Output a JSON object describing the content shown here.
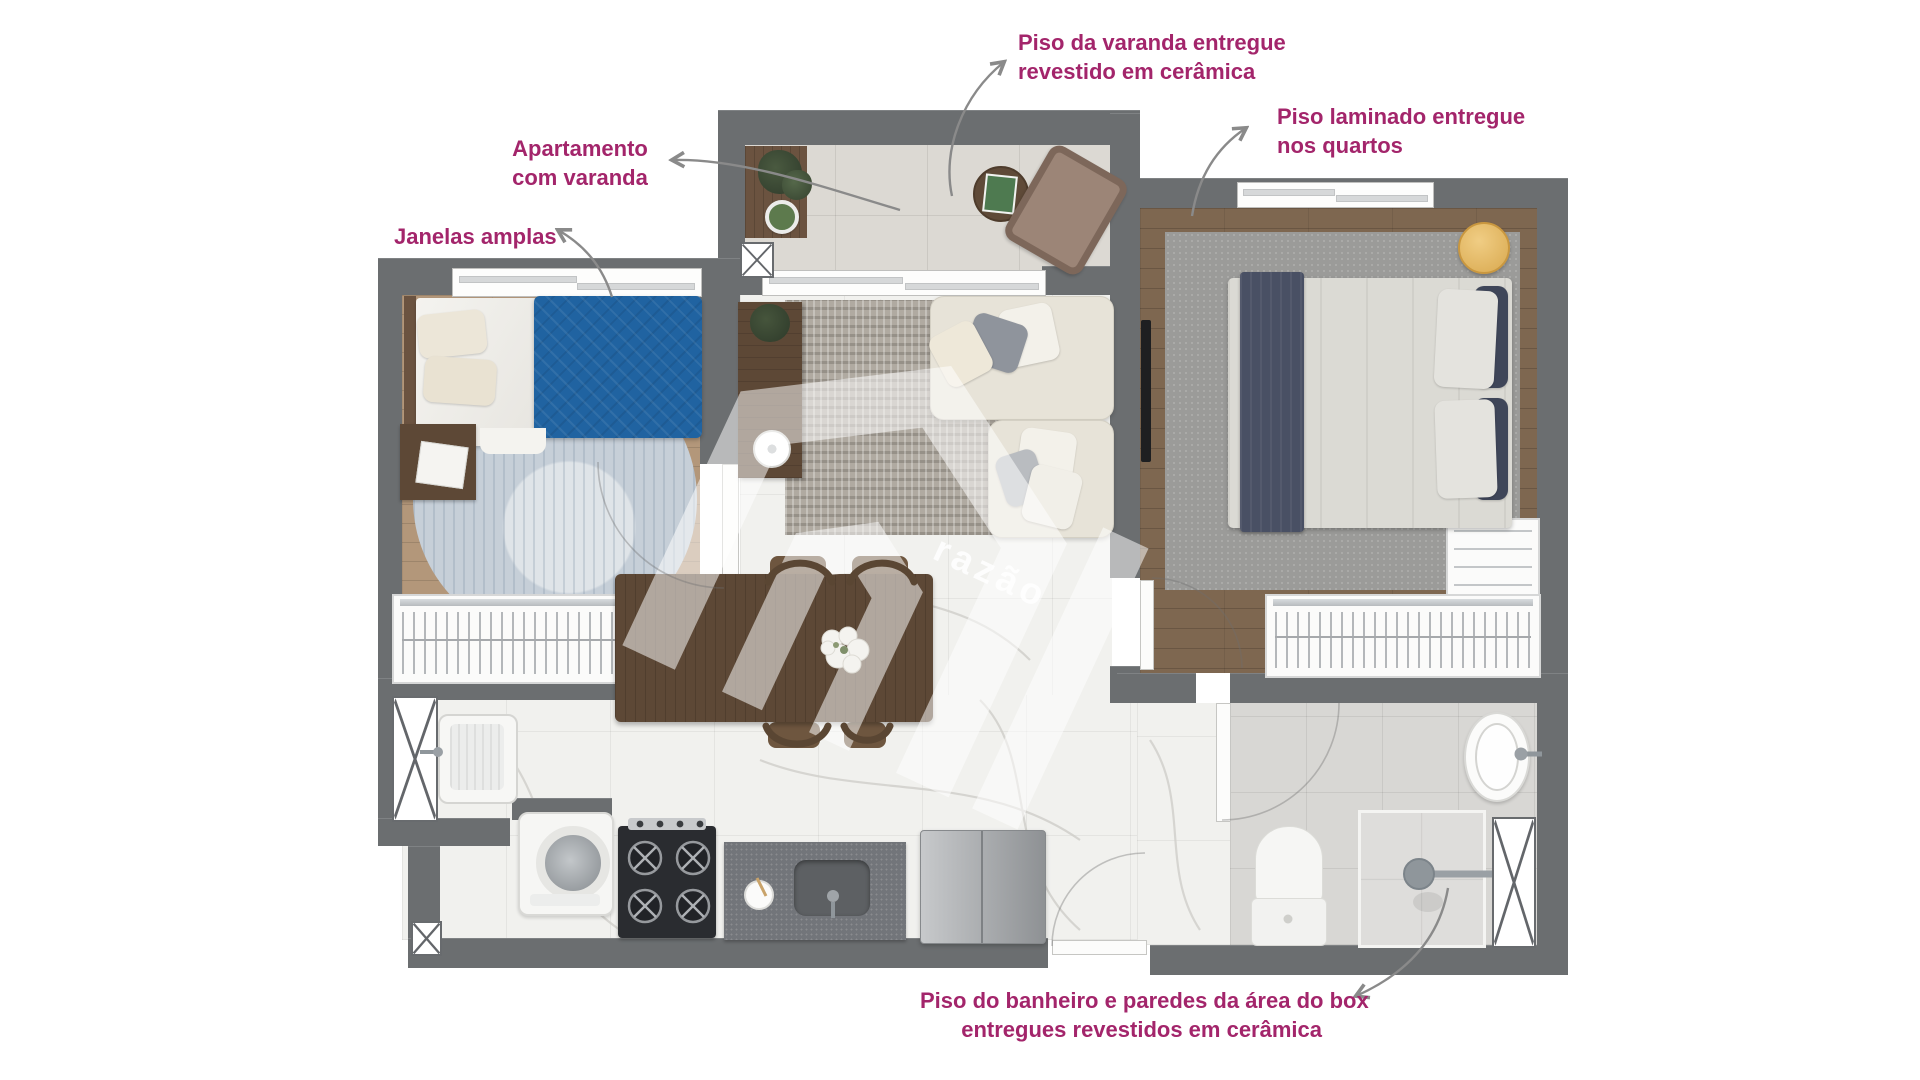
{
  "annotations": {
    "varanda": {
      "line1": "Piso da varanda entregue",
      "line2": "revestido em cerâmica"
    },
    "laminado": {
      "line1": "Piso laminado entregue",
      "line2": "nos quartos"
    },
    "apartamento": {
      "line1": "Apartamento",
      "line2": "com varanda"
    },
    "janelas": {
      "label": "Janelas amplas"
    },
    "banheiro": {
      "line1": "Piso do banheiro e paredes da área do box",
      "line2": "entregues revestidos em cerâmica"
    }
  },
  "watermark": {
    "brand": "razão"
  },
  "colors": {
    "annotation": "#a3256b",
    "arrow": "#8a8a8a",
    "wall": "#6b6e70",
    "marble_floor": "#f1f1ee",
    "balcony_tile": "#dcd9d3",
    "bathroom_tile": "#d8d7d4",
    "wood_light": "#b3977a",
    "wood_dark": "#7e6750",
    "furniture_wood": "#5d4836",
    "bed_blue": "#2063a1",
    "navy": "#495064",
    "sofa_cream": "#e7e3d8",
    "gold": "#e6bb66"
  }
}
